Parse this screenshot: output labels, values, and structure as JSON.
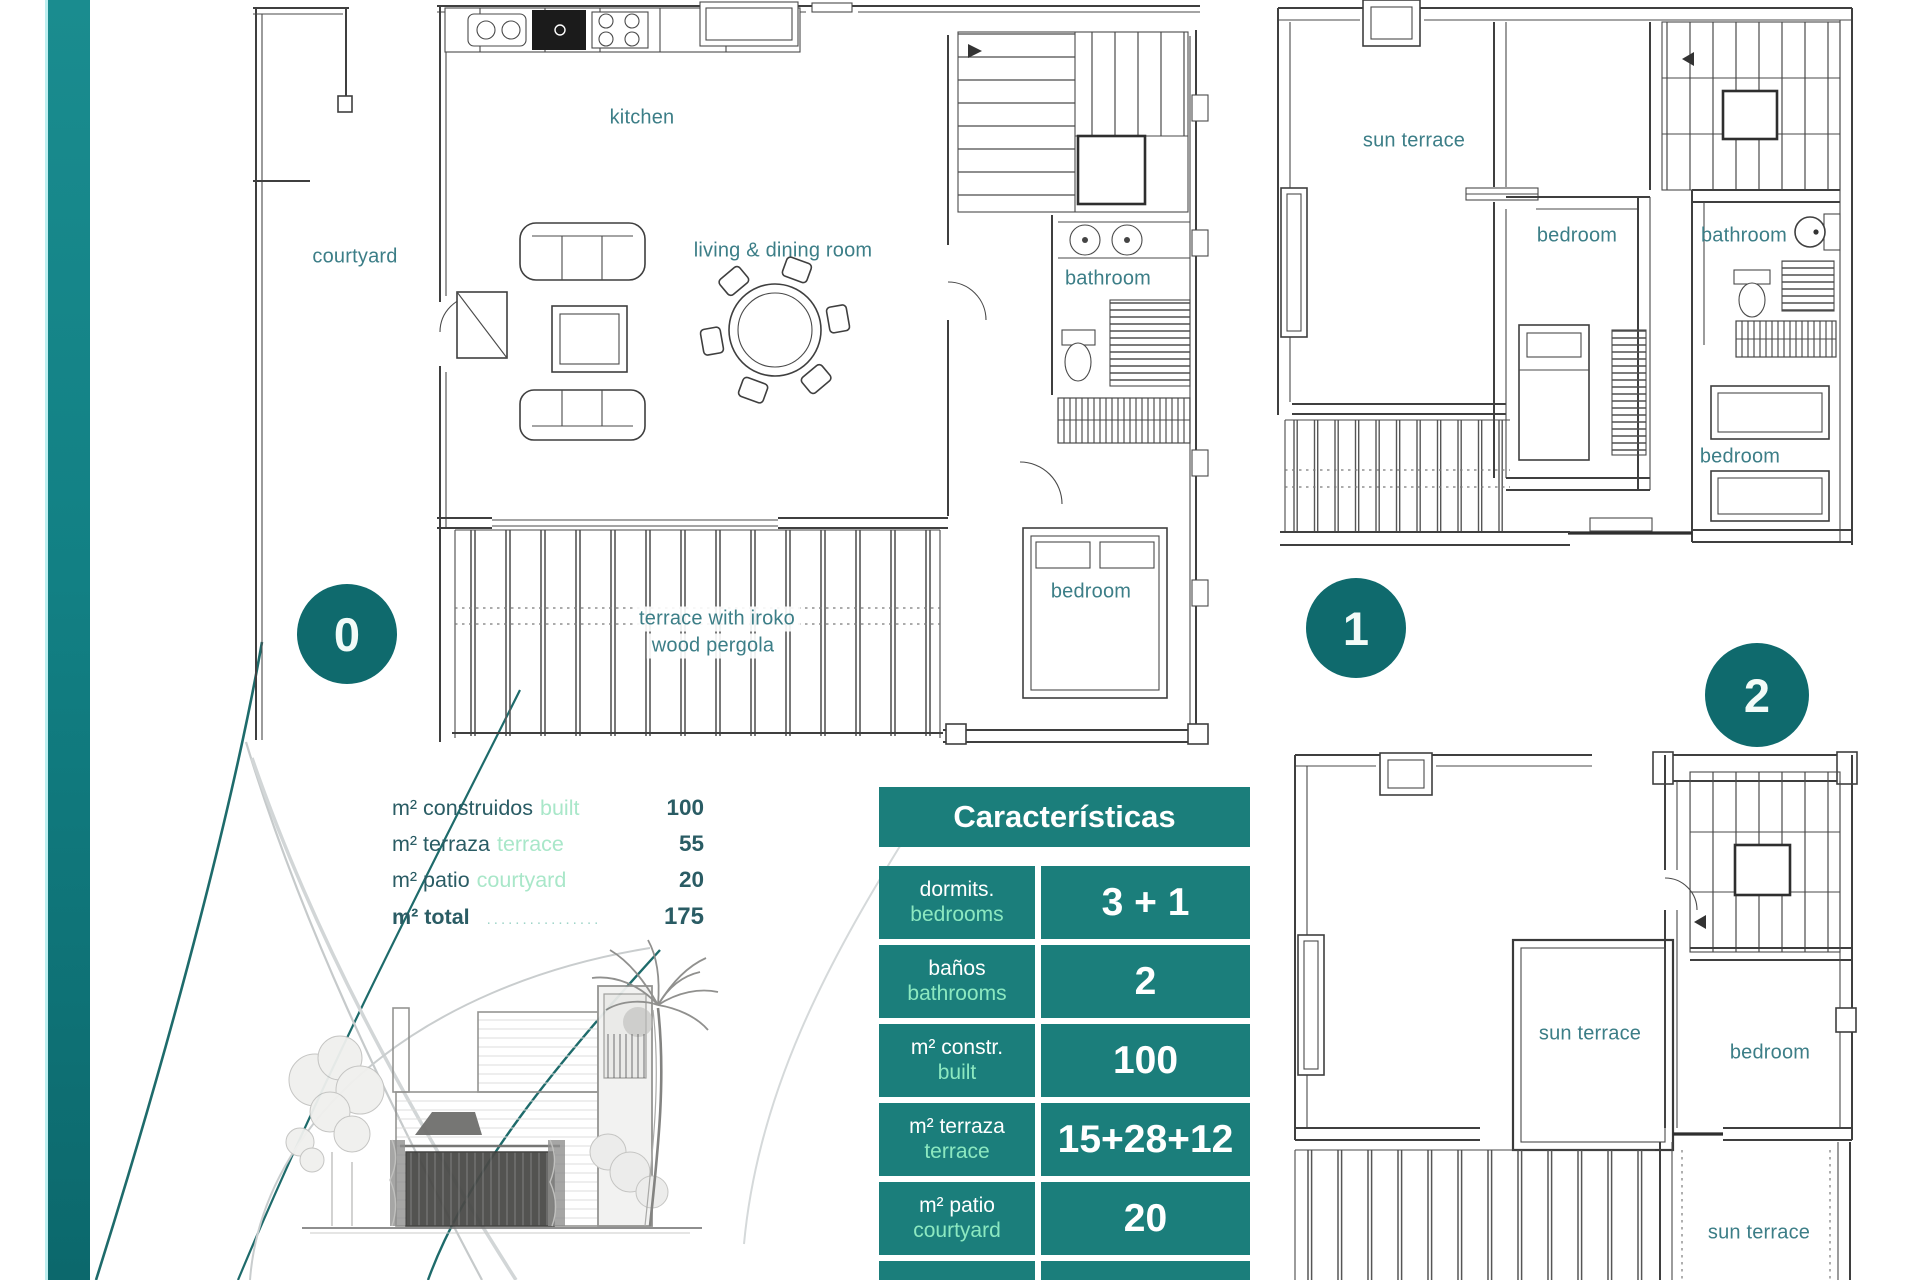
{
  "colors": {
    "table_teal": "#1b7e7b",
    "circle_teal": "#0f6a6d",
    "bar_teal_top": "#1a8c8f",
    "bar_teal_bottom": "#0c686c",
    "light_green": "#8ce8c0",
    "room_label_teal": "#3c7e87",
    "text_dark": "#2a5c64"
  },
  "floors": {
    "floor0": {
      "number": "0",
      "labels": {
        "kitchen": "kitchen",
        "courtyard": "courtyard",
        "living": "living & dining room",
        "bathroom": "bathroom",
        "bedroom": "bedroom",
        "terrace_line1": "terrace with iroko",
        "terrace_line2": "wood pergola"
      }
    },
    "floor1": {
      "number": "1",
      "labels": {
        "sun_terrace": "sun terrace",
        "bedroom_mid": "bedroom",
        "bathroom": "bathroom",
        "bedroom_bottom": "bedroom"
      }
    },
    "floor2": {
      "number": "2",
      "labels": {
        "sun_terrace_mid": "sun terrace",
        "bedroom": "bedroom",
        "sun_terrace_bottom": "sun terrace"
      }
    }
  },
  "measurements": {
    "rows": [
      {
        "es": "m² construidos",
        "en": "built",
        "value": "100"
      },
      {
        "es": "m² terraza",
        "en": "terrace",
        "value": "55"
      },
      {
        "es": "m² patio",
        "en": "courtyard",
        "value": "20"
      }
    ],
    "total": {
      "es": "m² total",
      "dots": "................",
      "value": "175"
    }
  },
  "table": {
    "title": "Características",
    "rows": [
      {
        "es": "dormits.",
        "en": "bedrooms",
        "value": "3 + 1"
      },
      {
        "es": "baños",
        "en": "bathrooms",
        "value": "2"
      },
      {
        "es": "m² constr.",
        "en": "built",
        "value": "100"
      },
      {
        "es": "m² terraza",
        "en": "terrace",
        "value": "15+28+12"
      },
      {
        "es": "m² patio",
        "en": "courtyard",
        "value": "20"
      },
      {
        "es": "m² parcela",
        "en": "",
        "value": "455"
      }
    ]
  }
}
